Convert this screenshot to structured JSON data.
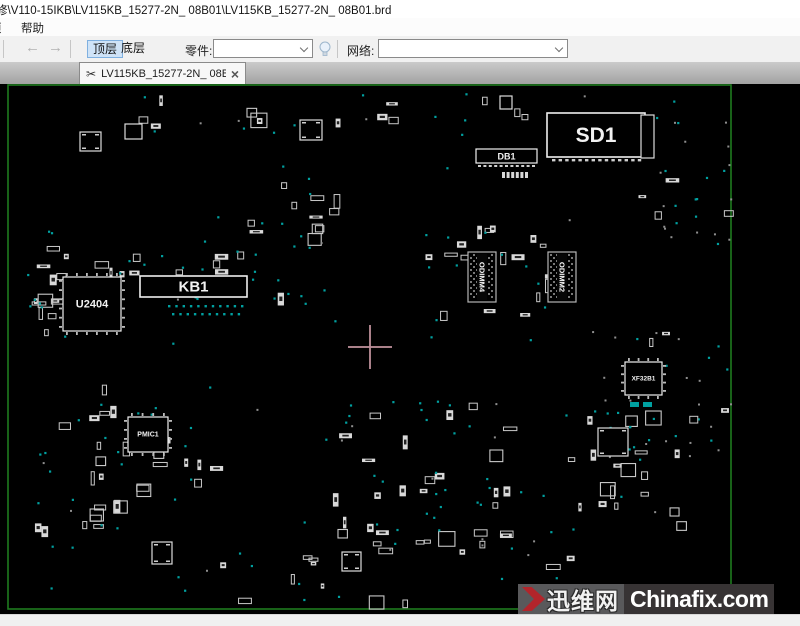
{
  "window": {
    "title": "修\\V110-15IKB\\LV115KB_15277-2N_ 08B01\\LV115KB_15277-2N_ 08B01.brd"
  },
  "menu": {
    "partial_item": "项",
    "items": [
      {
        "label": "帮助"
      }
    ]
  },
  "toolbar": {
    "back_glyph": "←",
    "forward_glyph": "→",
    "layer_top": "顶层",
    "layer_bottom": "底层",
    "part_label": "零件:",
    "part_value": "",
    "net_label": "网络:",
    "net_value": "",
    "bulb_icon": "lightbulb-icon"
  },
  "tabs": [
    {
      "icon": "✂",
      "label": "LV115KB_15277-2N_ 08B...",
      "close_glyph": "×"
    }
  ],
  "watermark": {
    "site_cn": "迅维网",
    "site_en": "Chinafix.com",
    "chevron_color": "#b2252b"
  },
  "board": {
    "background": "#000000",
    "outline": {
      "x": 8,
      "y": 1,
      "w": 723,
      "h": 524,
      "color": "#1e7a1e"
    },
    "crosshair": {
      "cx": 370,
      "cy": 263,
      "arm": 22,
      "color": "#bd8f9a"
    },
    "components": [
      {
        "ref": "SD1",
        "x": 547,
        "y": 29,
        "w": 98,
        "h": 44,
        "font": 21
      },
      {
        "ref": "DB1",
        "x": 476,
        "y": 65,
        "w": 61,
        "h": 14,
        "font": 9
      },
      {
        "ref": "KB1",
        "x": 140,
        "y": 192,
        "w": 107,
        "h": 21,
        "font": 15
      },
      {
        "ref": "U2404",
        "x": 63,
        "y": 193,
        "w": 58,
        "h": 54,
        "font": 11,
        "pins": true
      },
      {
        "ref": "PMIC1",
        "x": 128,
        "y": 333,
        "w": 40,
        "h": 35,
        "font": 7,
        "pins": true
      },
      {
        "ref": "XF32B1",
        "x": 625,
        "y": 278,
        "w": 37,
        "h": 33,
        "font": 6.5,
        "pins": true
      },
      {
        "ref": "ODIMM4",
        "type": "dimm",
        "x": 468,
        "y": 168,
        "w": 28,
        "h": 50,
        "font": 7.5
      },
      {
        "ref": "ODIMM2",
        "type": "dimm",
        "x": 548,
        "y": 168,
        "w": 28,
        "h": 50,
        "font": 7.5
      },
      {
        "type": "ic",
        "x": 80,
        "y": 48,
        "w": 21,
        "h": 19
      },
      {
        "type": "ic",
        "x": 300,
        "y": 36,
        "w": 22,
        "h": 20
      },
      {
        "type": "ic",
        "x": 125,
        "y": 40,
        "w": 17,
        "h": 15
      },
      {
        "type": "ic",
        "x": 500,
        "y": 12,
        "w": 12,
        "h": 13
      },
      {
        "type": "ic",
        "x": 641,
        "y": 31,
        "w": 13,
        "h": 43
      },
      {
        "type": "ic",
        "x": 598,
        "y": 344,
        "w": 30,
        "h": 28
      },
      {
        "type": "ic",
        "x": 152,
        "y": 458,
        "w": 20,
        "h": 22
      },
      {
        "type": "ic",
        "x": 342,
        "y": 468,
        "w": 19,
        "h": 19
      }
    ],
    "pad_rows": [
      {
        "x": 143,
        "y": 210,
        "n": 26,
        "dx": 4,
        "w": 2.4,
        "h": 1.5,
        "color": "#e0e0e0"
      },
      {
        "x": 168,
        "y": 221,
        "n": 11,
        "dx": 7.3,
        "w": 2.4,
        "h": 2.4,
        "color": "#00a0a0"
      },
      {
        "x": 172,
        "y": 229,
        "n": 10,
        "dx": 7.3,
        "w": 2.4,
        "h": 2.4,
        "color": "#00a0a0"
      },
      {
        "x": 478,
        "y": 81,
        "n": 11,
        "dx": 5.4,
        "w": 3,
        "h": 2,
        "color": "#cfcfcf"
      },
      {
        "x": 502,
        "y": 88,
        "n": 6,
        "dx": 4.6,
        "w": 3,
        "h": 6,
        "color": "#d8d8d8"
      },
      {
        "x": 552,
        "y": 75,
        "n": 14,
        "dx": 6.6,
        "w": 3.4,
        "h": 2.4,
        "color": "#cfcfcf"
      },
      {
        "x": 630,
        "y": 318,
        "n": 2,
        "dx": 13,
        "w": 9,
        "h": 5,
        "color": "#00a0a0"
      }
    ],
    "texture": {
      "seed": 11,
      "dot_color": "#00a0a0",
      "gray_dot_color": "#8f8f8f",
      "part_stroke": "#c9c9c9",
      "clusters": [
        {
          "x": 60,
          "y": 6,
          "w": 620,
          "h": 45,
          "rects": 15,
          "teal": 10,
          "gray": 3
        },
        {
          "x": 28,
          "y": 135,
          "w": 38,
          "h": 120,
          "rects": 13,
          "teal": 7,
          "gray": 0
        },
        {
          "x": 60,
          "y": 165,
          "w": 190,
          "h": 25,
          "rects": 10,
          "teal": 5,
          "gray": 0
        },
        {
          "x": 145,
          "y": 115,
          "w": 180,
          "h": 110,
          "rects": 5,
          "teal": 18,
          "gray": 0
        },
        {
          "x": 235,
          "y": 80,
          "w": 100,
          "h": 75,
          "rects": 8,
          "teal": 6,
          "gray": 0
        },
        {
          "x": 425,
          "y": 135,
          "w": 125,
          "h": 125,
          "rects": 17,
          "teal": 12,
          "gray": 0
        },
        {
          "x": 635,
          "y": 35,
          "w": 100,
          "h": 120,
          "rects": 4,
          "teal": 8,
          "gray": 14
        },
        {
          "x": 585,
          "y": 245,
          "w": 150,
          "h": 135,
          "rects": 5,
          "teal": 12,
          "gray": 16
        },
        {
          "x": 26,
          "y": 295,
          "w": 95,
          "h": 150,
          "rects": 16,
          "teal": 9,
          "gray": 2
        },
        {
          "x": 95,
          "y": 318,
          "w": 115,
          "h": 85,
          "rects": 13,
          "teal": 8,
          "gray": 0
        },
        {
          "x": 325,
          "y": 315,
          "w": 185,
          "h": 150,
          "rects": 30,
          "teal": 24,
          "gray": 6
        },
        {
          "x": 535,
          "y": 325,
          "w": 155,
          "h": 125,
          "rects": 17,
          "teal": 13,
          "gray": 3
        },
        {
          "x": 150,
          "y": 450,
          "w": 420,
          "h": 75,
          "rects": 12,
          "teal": 12,
          "gray": 4
        },
        {
          "x": 20,
          "y": 5,
          "w": 700,
          "h": 515,
          "rects": 0,
          "teal": 22,
          "gray": 6
        }
      ]
    }
  }
}
